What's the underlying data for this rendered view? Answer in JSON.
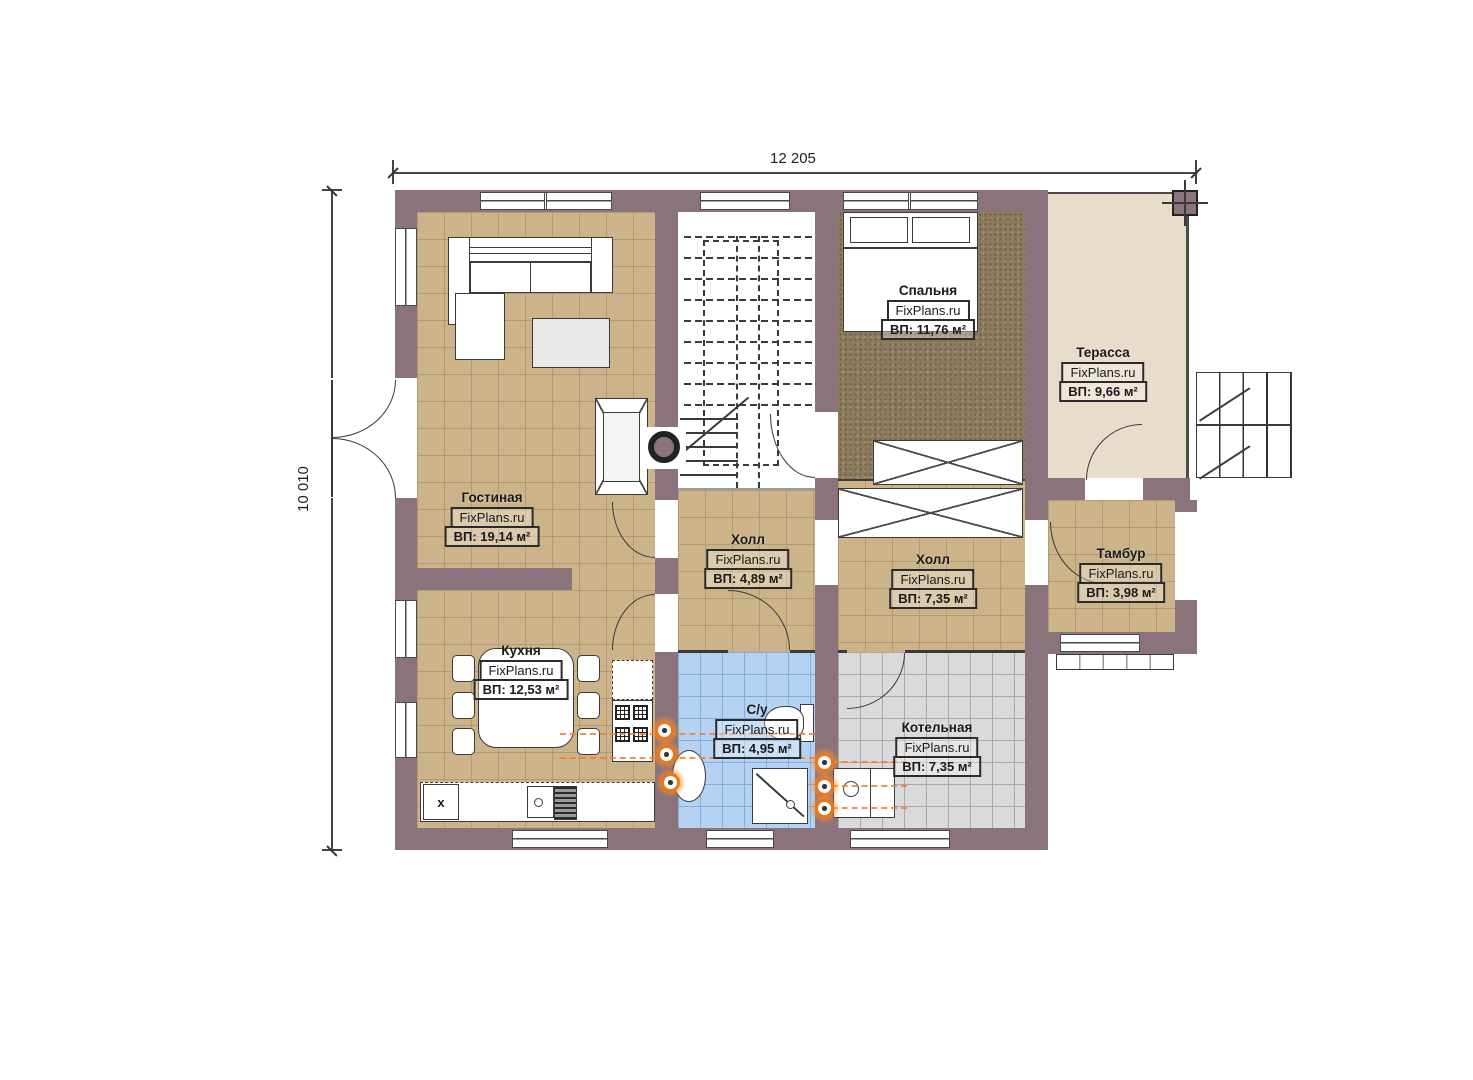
{
  "plan": {
    "watermark": "FixPlans.ru",
    "dimensions": {
      "width_label": "12 205",
      "height_label": "10 010"
    },
    "rooms": [
      {
        "name": "Гостиная",
        "area": "ВП: 19,14 м²"
      },
      {
        "name": "Кухня",
        "area": "ВП: 12,53 м²"
      },
      {
        "name": "Холл",
        "area": "ВП: 4,89 м²"
      },
      {
        "name": "Спальня",
        "area": "ВП: 11,76 м²"
      },
      {
        "name": "Терасса",
        "area": "ВП: 9,66 м²"
      },
      {
        "name": "Холл",
        "area": "ВП: 7,35 м²"
      },
      {
        "name": "Тамбур",
        "area": "ВП: 3,98 м²"
      },
      {
        "name": "С/у",
        "area": "ВП: 4,95 м²"
      },
      {
        "name": "Котельная",
        "area": "ВП: 7,35 м²"
      }
    ],
    "markers": {
      "fridge_label": "x"
    },
    "colors": {
      "wall": "#8a737a",
      "floor_tile_tan": "#cdb389",
      "floor_carpet": "#8d7b5e",
      "floor_bath": "#b5d2f2",
      "floor_boiler": "#dadada",
      "floor_terrace": "#e8dccb",
      "plumbing_accent": "#e87722"
    }
  }
}
